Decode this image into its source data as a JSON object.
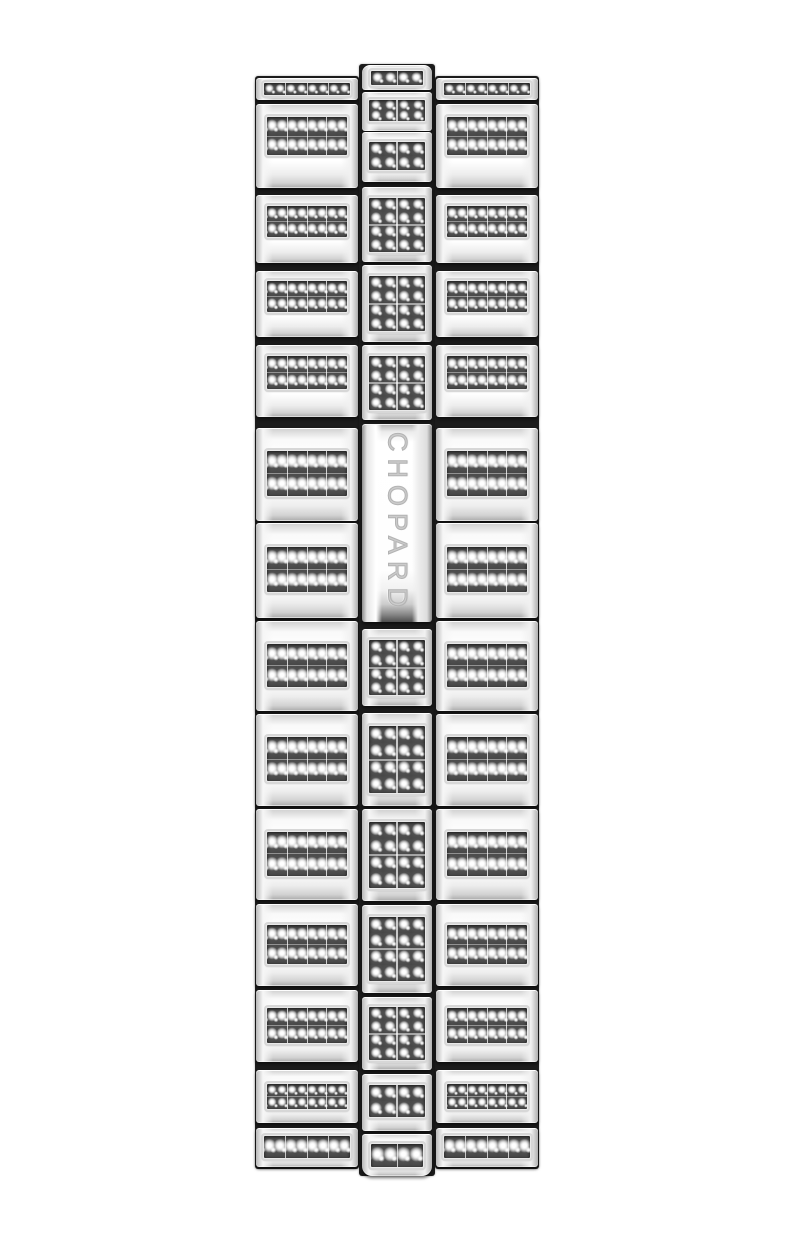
{
  "page": {
    "background_color": "#ffffff",
    "description": "Product photograph of a diamond-pave polished white-metal link bracelet shown vertically on a plain white background, clasp side facing the viewer"
  },
  "product": {
    "brand_engraving": "CHOPARD"
  },
  "colors": {
    "metal_highlight": "#ffffff",
    "metal_mid": "#ececec",
    "metal_edge": "#b0b0b0",
    "crevice_shadow": "#1c1c1c",
    "pave_background": "#4e4e4e",
    "diamond": "#ffffff",
    "engraving": "#cbcbcb"
  },
  "layout": {
    "bracelet": {
      "x": 255,
      "y": 64,
      "width": 284,
      "height": 1112
    },
    "columns": {
      "left": {
        "x": 0,
        "width": 104,
        "top": 12,
        "height": 1093
      },
      "center": {
        "x": 104,
        "width": 76,
        "top": 0,
        "height": 1112
      },
      "right": {
        "x": 180,
        "width": 104,
        "top": 12,
        "height": 1093
      }
    },
    "side_rows": [
      {
        "top": 14,
        "height": 22,
        "pave": "s1",
        "zone": "upper"
      },
      {
        "top": 40,
        "height": 84,
        "pave": "s2",
        "zone": "upper"
      },
      {
        "top": 131,
        "height": 68,
        "pave": "s2",
        "zone": "upper"
      },
      {
        "top": 207,
        "height": 66,
        "pave": "s2",
        "zone": "upper"
      },
      {
        "top": 281,
        "height": 72,
        "pave": "s2",
        "zone": "upper"
      },
      {
        "top": 364,
        "height": 93,
        "pave": "s2",
        "zone": "lower"
      },
      {
        "top": 459,
        "height": 95,
        "pave": "s2",
        "zone": "lower"
      },
      {
        "top": 557,
        "height": 90,
        "pave": "s2",
        "zone": "lower"
      },
      {
        "top": 650,
        "height": 92,
        "pave": "s2",
        "zone": "lower"
      },
      {
        "top": 745,
        "height": 91,
        "pave": "s2",
        "zone": "lower"
      },
      {
        "top": 840,
        "height": 82,
        "pave": "s2",
        "zone": "lower"
      },
      {
        "top": 926,
        "height": 72,
        "pave": "s2",
        "zone": "lower"
      },
      {
        "top": 1006,
        "height": 53,
        "pave": "s2",
        "zone": "lower"
      },
      {
        "top": 1064,
        "height": 39,
        "pave": "s1",
        "zone": "lower"
      }
    ],
    "center_links": [
      {
        "top": 1,
        "height": 25,
        "pave": "c1",
        "cap": "top"
      },
      {
        "top": 28,
        "height": 39,
        "pave": "c2"
      },
      {
        "top": 68,
        "height": 50,
        "pave": "c2"
      },
      {
        "top": 123,
        "height": 75,
        "pave": "c4"
      },
      {
        "top": 201,
        "height": 77,
        "pave": "c4"
      },
      {
        "top": 281,
        "height": 75,
        "pave": "c4"
      },
      {
        "top": 565,
        "height": 77,
        "pave": "c4"
      },
      {
        "top": 649,
        "height": 93,
        "pave": "c4"
      },
      {
        "top": 745,
        "height": 92,
        "pave": "c4"
      },
      {
        "top": 841,
        "height": 88,
        "pave": "c4"
      },
      {
        "top": 933,
        "height": 73,
        "pave": "c4"
      },
      {
        "top": 1010,
        "height": 57,
        "pave": "c2"
      },
      {
        "top": 1070,
        "height": 42,
        "pave": "c1",
        "cap": "bottom"
      }
    ],
    "clasp": {
      "top": 360,
      "height": 198
    }
  }
}
